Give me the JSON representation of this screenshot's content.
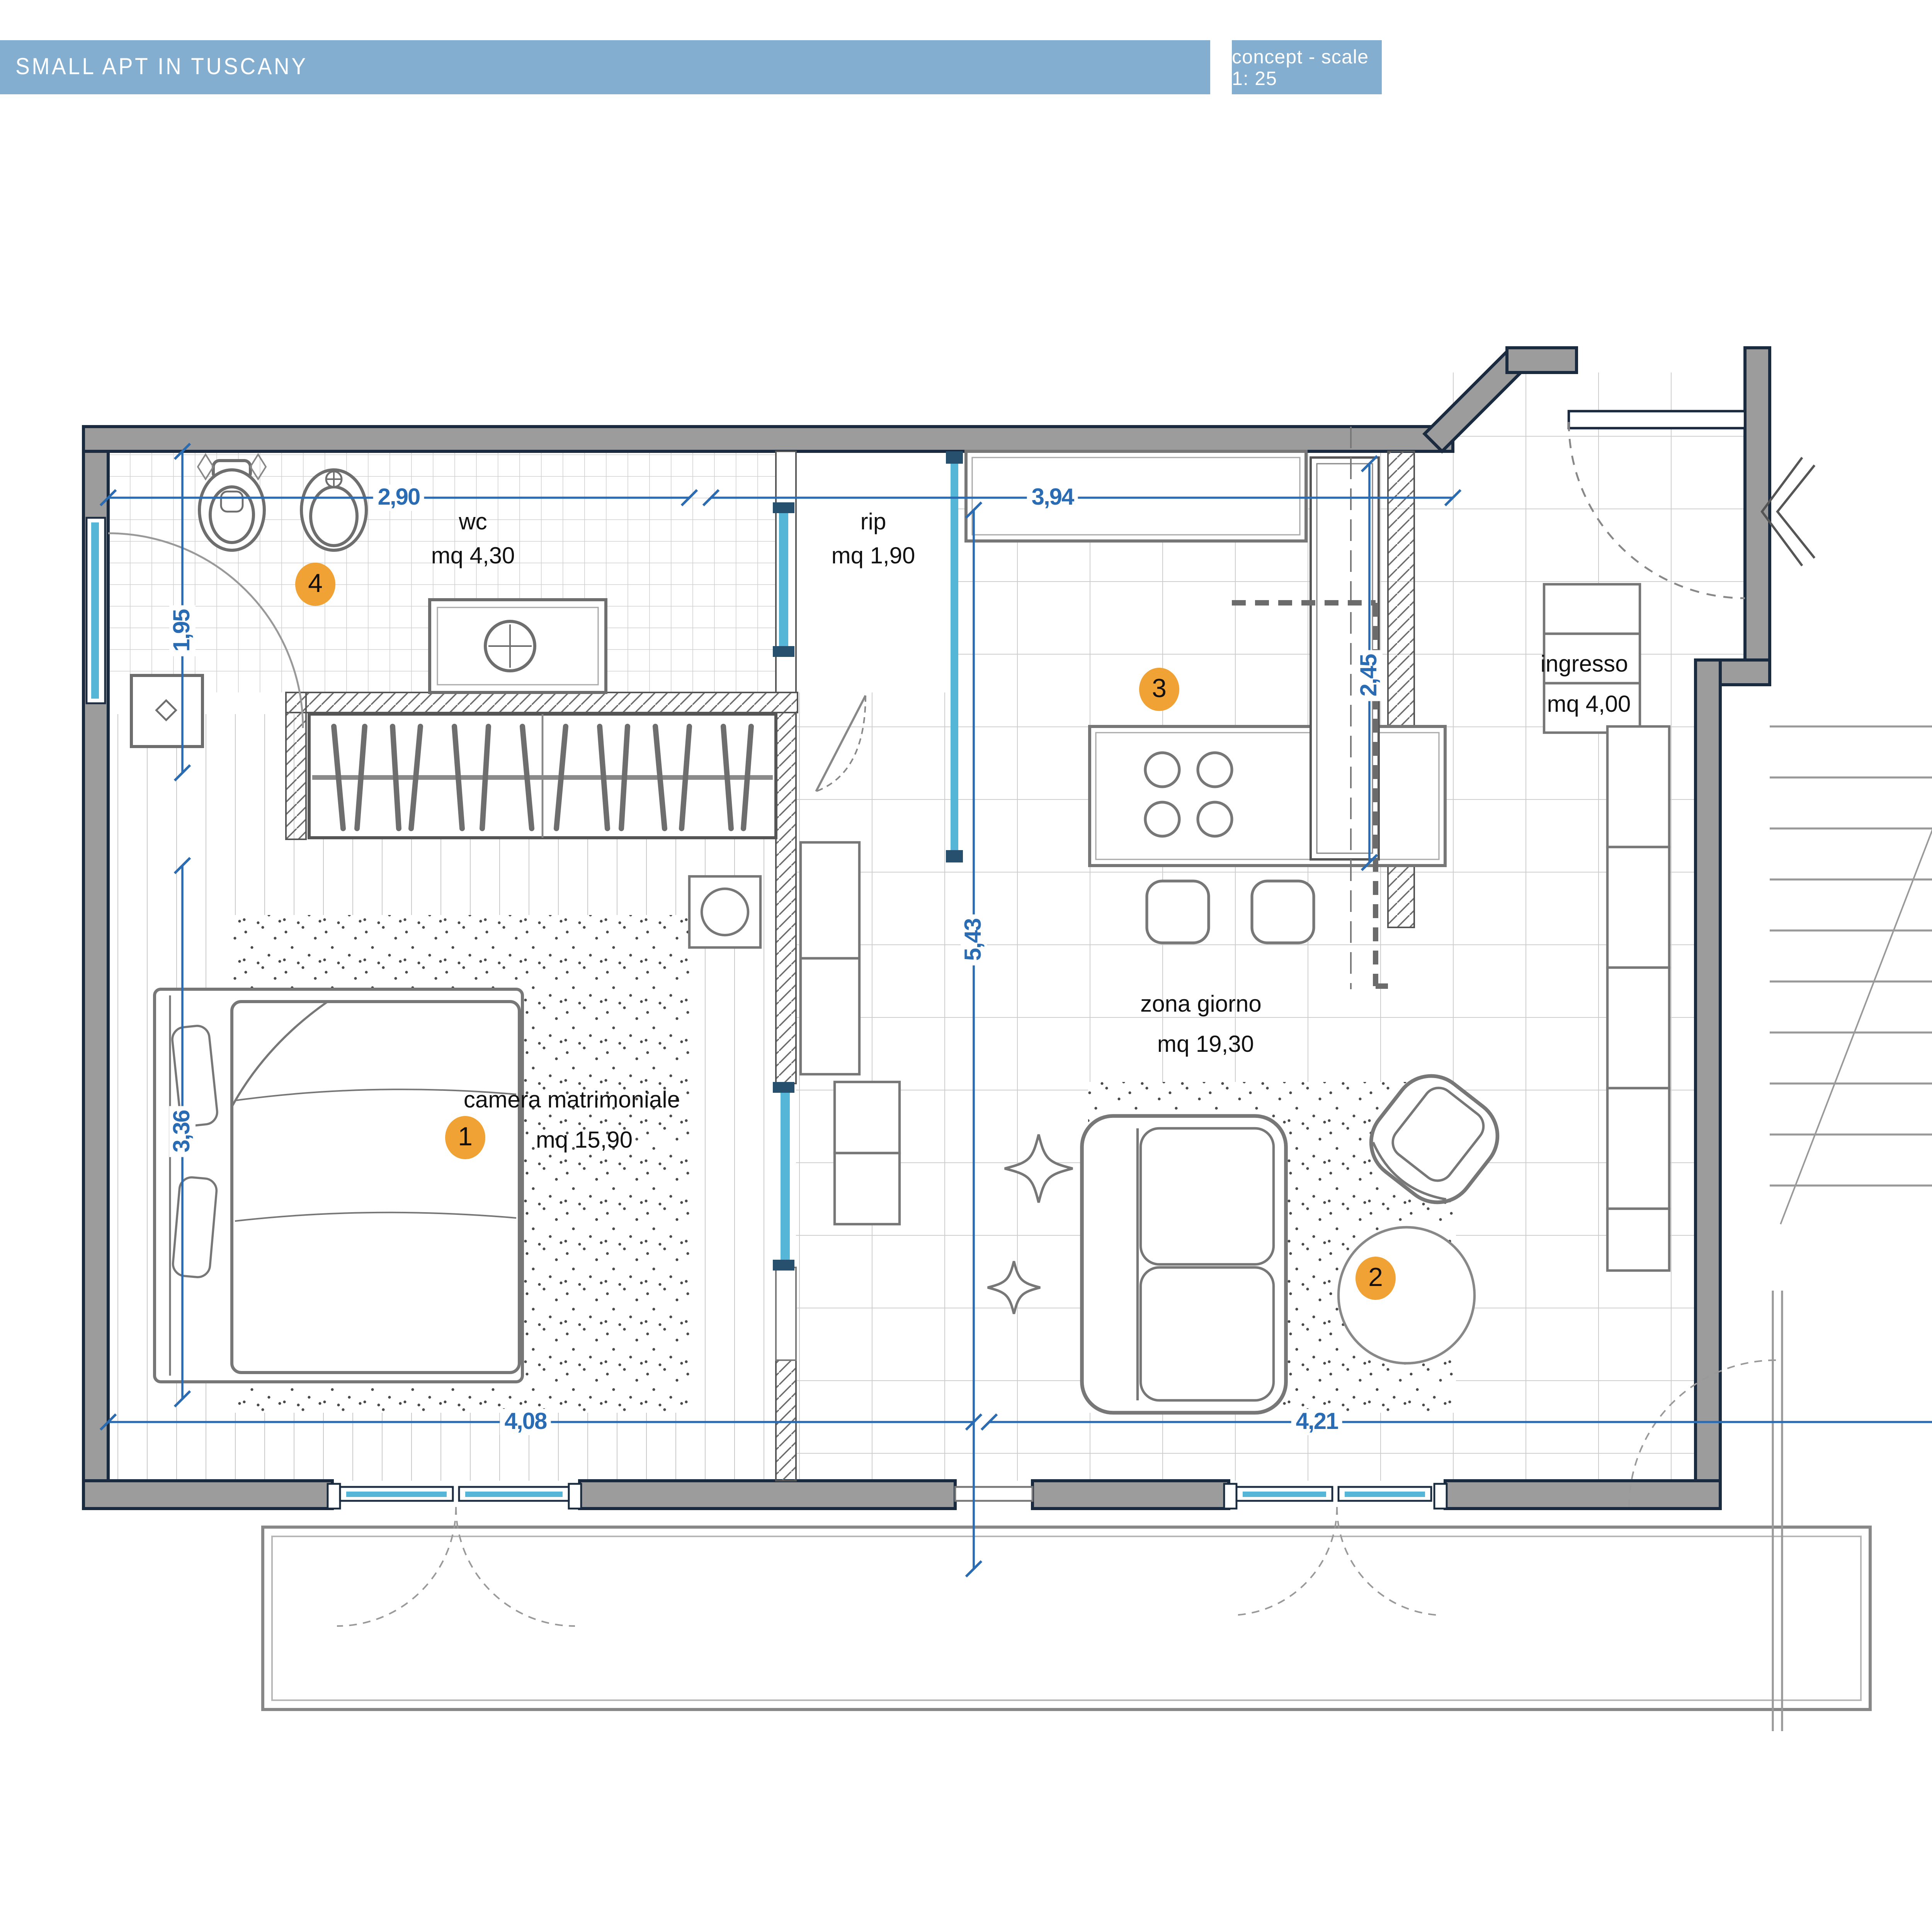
{
  "header": {
    "title": "SMALL APT IN TUSCANY",
    "subtitle": "concept - scale 1: 25"
  },
  "plan": {
    "rooms": {
      "wc": {
        "name": "wc",
        "area": "mq 4,30"
      },
      "rip": {
        "name": "rip",
        "area": "mq 1,90"
      },
      "ingresso": {
        "name": "ingresso",
        "area": "mq 4,00"
      },
      "camera": {
        "name": "camera matrimoniale",
        "area": "mq 15,90"
      },
      "zona_giorno": {
        "name": "zona giorno",
        "area": "mq 19,30"
      }
    },
    "markers": {
      "camera": "1",
      "zona_giorno": "2",
      "cucina": "3",
      "bagno": "4"
    },
    "dimensions": {
      "wc_width": "2,90",
      "kitchen_width": "3,94",
      "wc_depth": "1,95",
      "bedroom_depth": "3,36",
      "living_depth": "5,43",
      "entry_depth": "2,45",
      "bedroom_width": "4,08",
      "living_width": "4,21"
    }
  },
  "legend": {
    "items": [
      {
        "number": "1",
        "title": "Zona notte",
        "caption": "Letto matrimoniale Misuraemme Bridge",
        "url": "http://www.misuraemme.it/prodotti/letto_imbottito_bridge_103_it.html"
      },
      {
        "number": "2",
        "title": "Zona giorno",
        "caption": "Mobili zona giorno Novamobili",
        "url": "http://www.novamobili.it/ita/ambienti/zona-giorno/boiserie"
      },
      {
        "number": "3",
        "title": "Cucina",
        "caption": "Cucina Scavolini Urban",
        "url": "http://www.scavolini.com/Cucine/Urban"
      },
      {
        "number": "4",
        "title": "Bagno",
        "caption": "Sanitari azienda Cielo",
        "url": "http://www.ceramicacielo.it/it/sanitari/lavabo-da-appoggio-SHCOLAT40/"
      }
    ]
  },
  "photos": {
    "notte_watermark": "+",
    "bagno_watermark": "cielo"
  },
  "colors": {
    "header_blue": "#84aecf",
    "marker_orange": "#f0a235",
    "dimension_blue": "#2a6cb3",
    "wall_gray": "#9c9c9c",
    "wall_outline": "#1a2b3f",
    "glass_cyan": "#56b6d8"
  }
}
